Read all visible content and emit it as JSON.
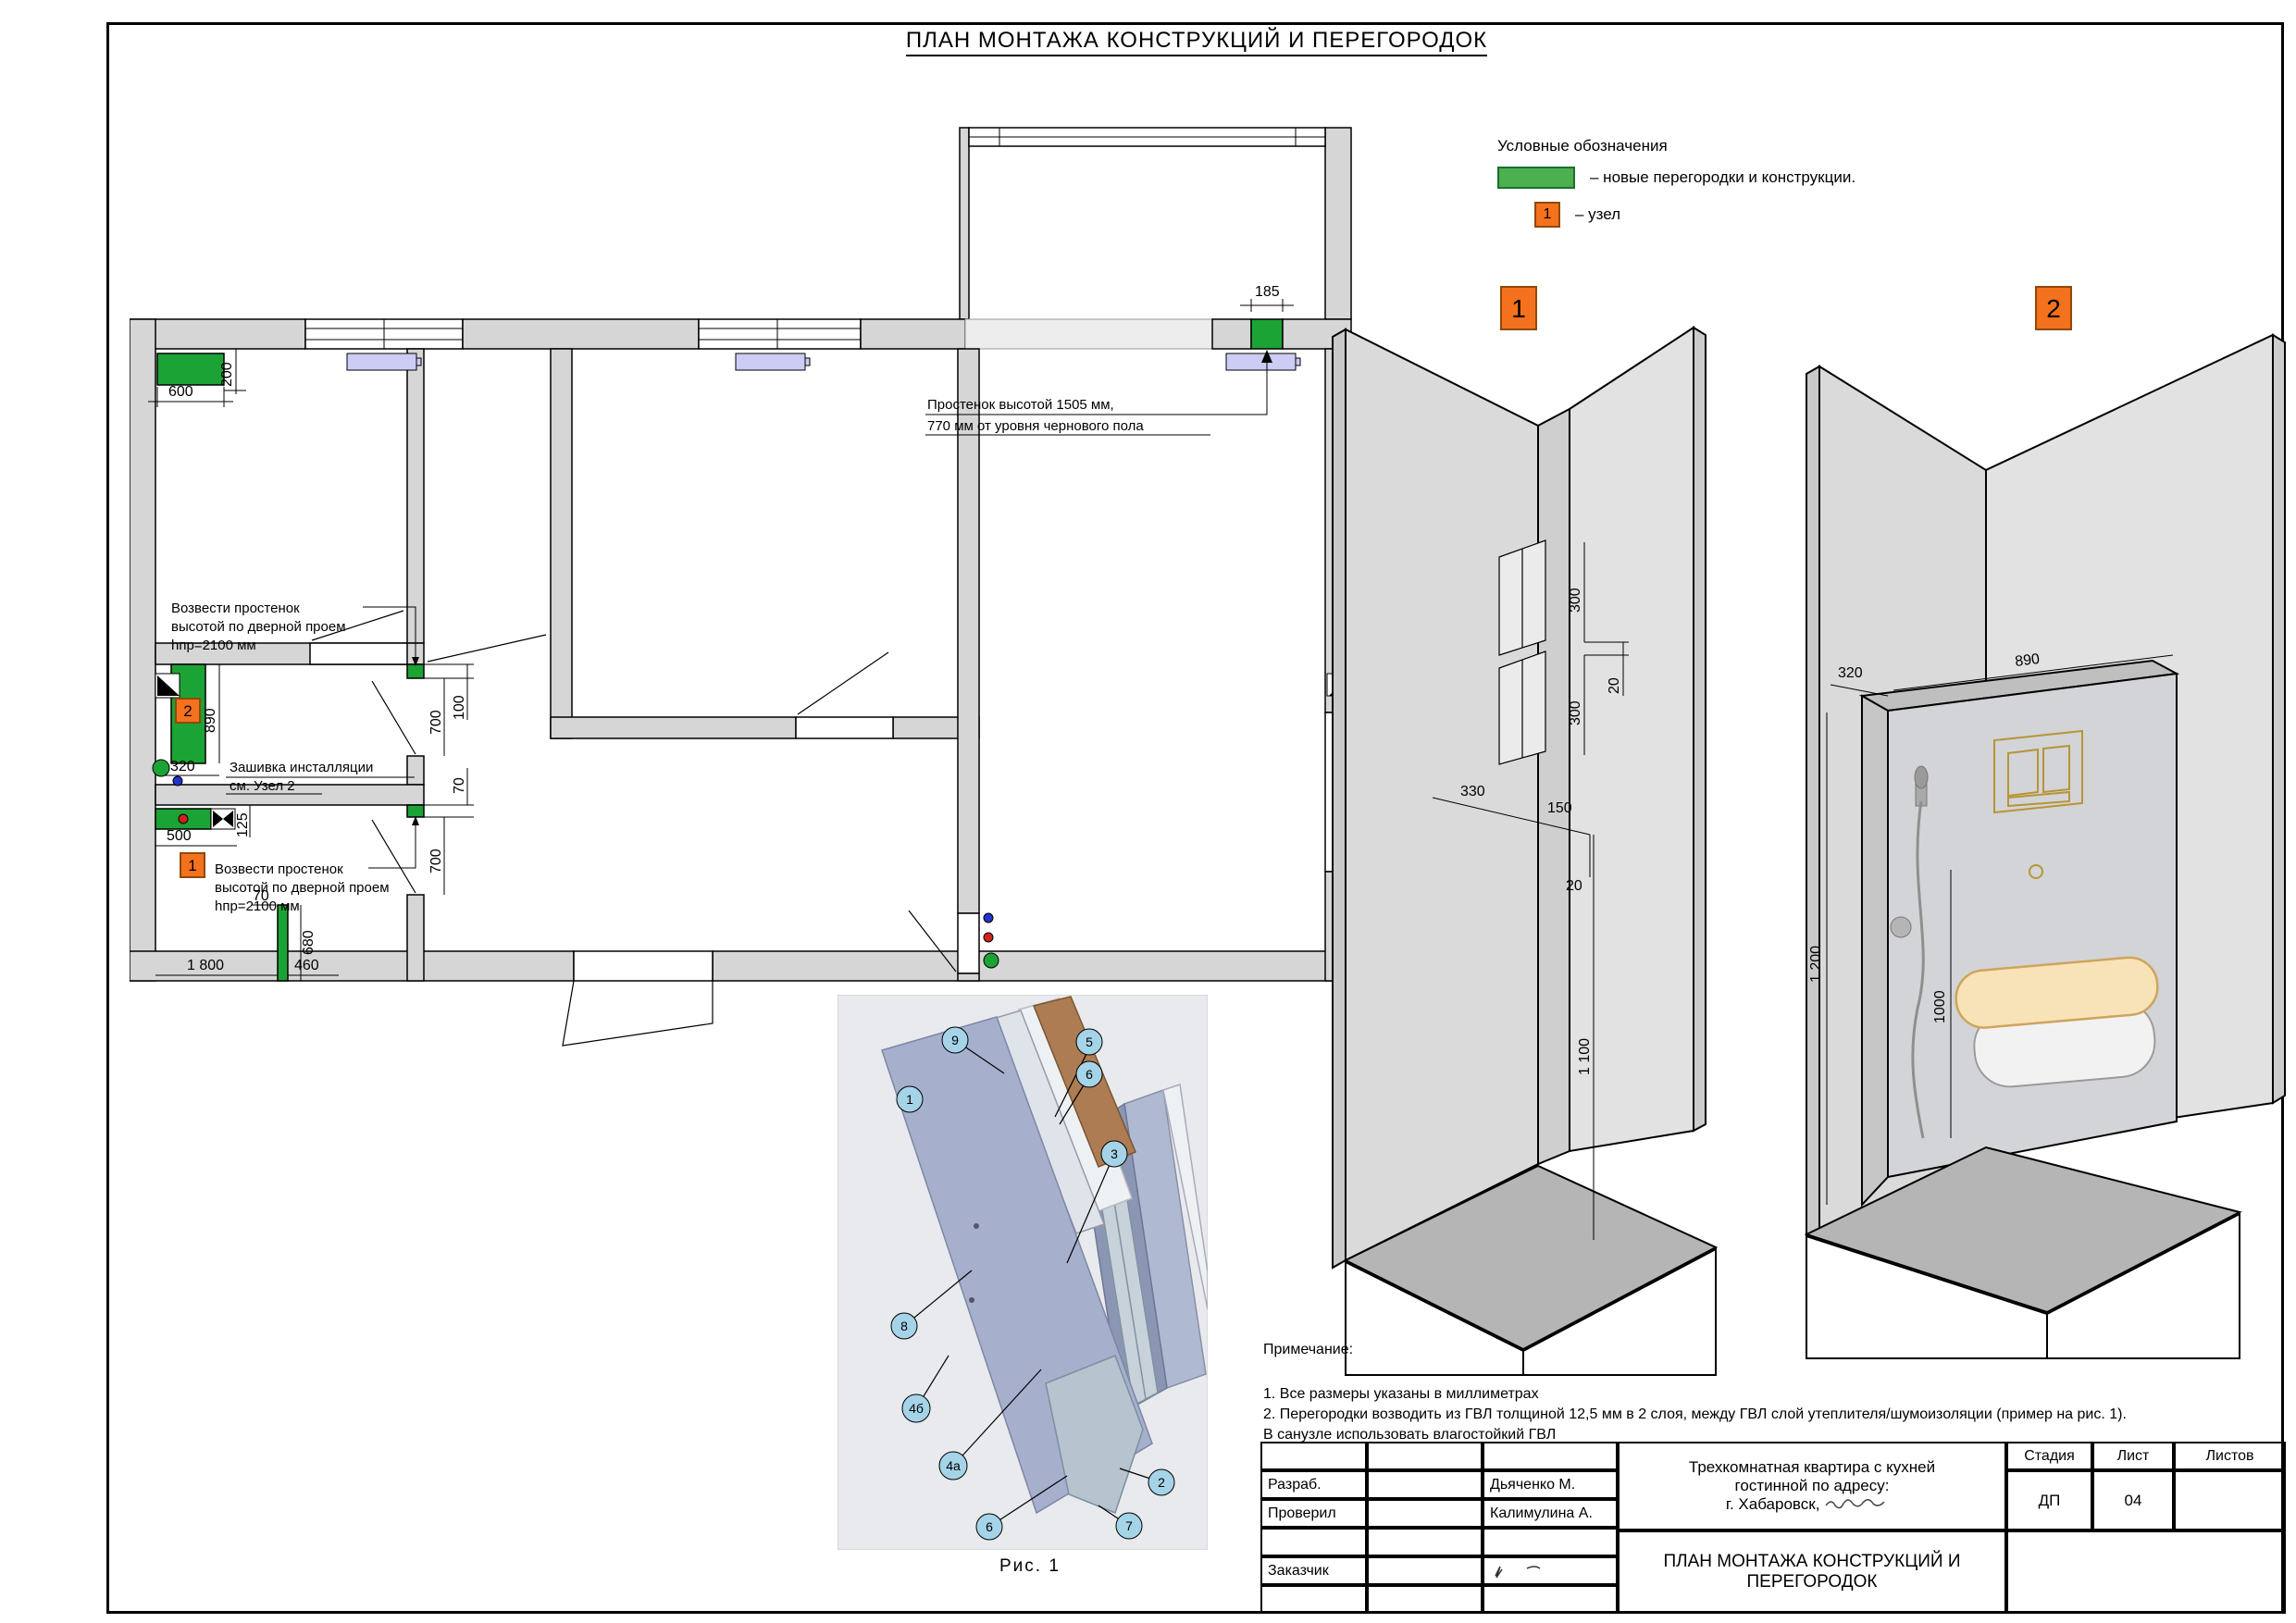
{
  "page": {
    "title": "ПЛАН МОНТАЖА КОНСТРУКЦИЙ И ПЕРЕГОРОДОК"
  },
  "colors": {
    "new_wall_green": "#1CA335",
    "legend_green": "#4CAF50",
    "node_orange": "#F4711D",
    "radiator_lavender": "#CCCCF4"
  },
  "legend": {
    "title": "Условные обозначения",
    "new_walls": "– новые перегородки и конструкции.",
    "node": "– узел",
    "node_num": "1"
  },
  "plan": {
    "pier_note_l1": "Простенок высотой 1505 мм,",
    "pier_note_l2": "770 мм от уровня чернового пола",
    "build_note_l1": "Возвести простенок",
    "build_note_l2": "высотой по дверной проем",
    "build_note_l3": "hпр=2100 мм",
    "sheathing_l1": "Зашивка инсталляции",
    "sheathing_l2": "см. Узел 2",
    "node1": "1",
    "node2": "2",
    "dims": {
      "d600": "600",
      "d200": "200",
      "d890": "890",
      "d320": "320",
      "d500": "500",
      "d125": "125",
      "d70": "70",
      "d680": "680",
      "d460": "460",
      "d1800": "1 800",
      "d700": "700",
      "d100": "100",
      "d70b": "70",
      "d185": "185"
    }
  },
  "view1": {
    "label": "1",
    "dims": {
      "d300": "300",
      "d20": "20",
      "d330": "330",
      "d150": "150",
      "d1100": "1 100"
    }
  },
  "view2": {
    "label": "2",
    "dims": {
      "d890": "890",
      "d320": "320",
      "d1200": "1 200",
      "d1000": "1000"
    }
  },
  "figure": {
    "caption": "Рис. 1",
    "callouts": [
      "1",
      "2",
      "3",
      "4а",
      "4б",
      "5",
      "6",
      "7",
      "8",
      "9",
      "10"
    ]
  },
  "notes": {
    "title": "Примечание:",
    "l1": "1. Все размеры указаны в миллиметрах",
    "l2": "2. Перегородки возводить из ГВЛ толщиной 12,5 мм в 2 слоя, между ГВЛ слой утеплителя/шумоизоляции (пример на рис. 1).",
    "l3": "В санузле использовать влагостойкий ГВЛ"
  },
  "titleblock": {
    "developed_label": "Разраб.",
    "developed_name": "Дьяченко М.",
    "checked_label": "Проверил",
    "checked_name": "Калимулина А.",
    "client_label": "Заказчик",
    "project_l1": "Трехкомнатная квартира с кухней",
    "project_l2": "гостинной по адресу:",
    "project_l3": "г. Хабаровск,",
    "doc_l1": "ПЛАН МОНТАЖА КОНСТРУКЦИЙ И",
    "doc_l2": "ПЕРЕГОРОДОК",
    "stage_h": "Стадия",
    "sheet_h": "Лист",
    "sheets_h": "Листов",
    "stage": "ДП",
    "sheet_no": "04",
    "sheets": ""
  }
}
